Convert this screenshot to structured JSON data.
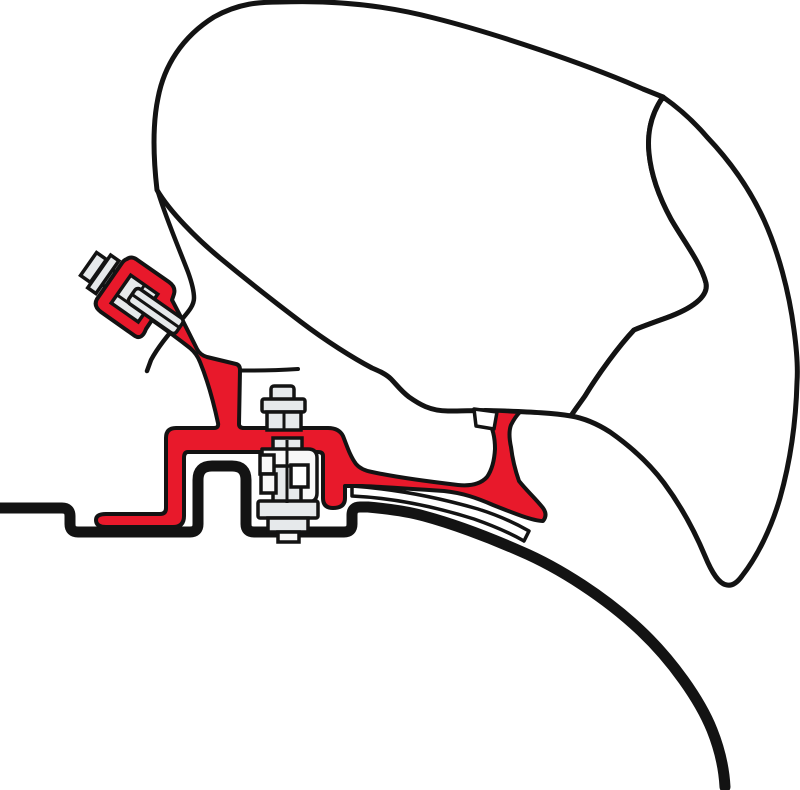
{
  "image": {
    "width": 800,
    "height": 790,
    "background": "#ffffff"
  },
  "diagram": {
    "kind": "technical-illustration",
    "subject": "awning-to-roof adapter bracket, side cross-section",
    "text_content": "none",
    "colors": {
      "outline": "#131313",
      "bracket_red": "#e8192b",
      "roof_cyan": "#2adde8",
      "metal_gray": "#e6e9eb",
      "metal_light": "#f8f8f8",
      "white": "#ffffff"
    },
    "parts": [
      {
        "name": "awning-case",
        "description": "large rounded awning cassette body, white with black outline"
      },
      {
        "name": "awning-front-panel",
        "description": "curved crescent front cover hanging down on the right"
      },
      {
        "name": "adapter-bracket",
        "description": "red mounting bracket: clamp ring, diagonal arm, post, horizontal rail, left foot, hanging finger, right strut with curved foot"
      },
      {
        "name": "clamp-bolt",
        "description": "tilted gray bolt with head, washer, shaft and clamped block at upper left"
      },
      {
        "name": "rail-bolt",
        "description": "vertical gray bolt through rail with C-clamp bracket and nut stack"
      },
      {
        "name": "mounting-shim",
        "description": "thin white curved spacer strip under red foot"
      },
      {
        "name": "support-pad",
        "description": "small white pad at top of right strut"
      },
      {
        "name": "roof-profile",
        "description": "cyan vehicle roof contour with raised rib and curved descent to lower right"
      }
    ]
  },
  "paths": {
    "case_body": "M157,190 C153,155 153,122 158,98 C164,66 182,37 214,17 C239,3 260,2 280,2 C332,0 384,5 434,18 C494,33 586,64 643,89 L663,97 C651,114 647,133 649,153 C651,174 659,197 671,219 C683,240 701,263 706,283 C709,297 691,309 666,318 C652,323 641,327 634,330 C619,346 599,373 585,396 C578,406 574,411 571,416 C553,413 531,412 505,411 C482,410 461,411 448,411 C430,411 419,404 409,397 C401,391 396,384 391,379 C386,374 379,371 372,368 C353,358 326,341 301,322 C272,300 243,277 220,258 C197,239 170,212 157,190 Z",
    "front_panel": "M663,97 C673,104 690,117 707,137 C727,158 748,185 764,220 C778,251 789,291 794,330 C797,352 798,368 797,382 C796,420 791,459 780,498 C771,529 757,557 742,576 C737,583 732,586 727,585 C719,584 712,573 705,556 C695,532 681,506 664,483 C649,463 630,446 610,432 C596,423 583,418 571,416 C574,411 578,406 585,396 C599,373 619,346 634,330 C641,327 652,323 666,318 C691,309 709,297 706,283 C701,263 683,240 671,219 C659,197 651,174 649,153 C647,133 651,114 663,97 Z",
    "case_edge_line": "M158,192 C166,218 178,246 188,272 C192,283 194,291 194,298 C194,305 189,311 183,318 C172,330 159,345 151,360 L147,371",
    "case_bottom_line": "M210,369 C237,371 268,371 298,369",
    "roof_line": "M0,508 L62,508 Q70,508 70,516 L70,524 Q70,532 78,532 L190,532 Q198,532 198,524 L198,480 Q198,466 212,466 L232,466 Q246,466 246,480 L246,524 Q246,532 254,532 L344,532 Q352,532 352,524 L352,515 Q352,507 360,507 L368,507 C390,509 410,512 424,516 C450,523 486,536 520,551 C560,568 606,598 640,630 C672,660 700,700 712,730 C720,750 724,768 725,787",
    "shim": "M352,486 C395,489 440,498 478,509 C497,515 515,523 529,531 L524,541 C510,533 494,526 474,519 C436,507 393,498 352,496 Z",
    "bracket_red": "M127,259 Q131,256 136,259 L169,282 Q176,287 174,294 L172,300 C180,315 190,335 197,349 Q200,355 207,357 L236,364 Q240,365 240,370 L239,424 Q239,428 244,428 L328,428 Q339,428 343,436 C347,446 350,456 356,464 Q361,470 372,472 C395,477 424,481 458,485 Q478,487 487,477 Q494,467 495,449 Q495,431 488,421 Q484,415 480,413 L485,410 L520,412 Q515,417 511,425 Q508,433 511,447 Q513,464 519,481 C526,490 536,499 543,508 Q548,515 543,521 C533,521 513,513 493,505 C477,498 463,493 444,491 C415,489 385,487 362,486 L345,486 L345,498 Q345,508 333,508 Q323,508 323,498 L323,456 Q323,452 318,452 L188,452 Q184,452 184,458 L184,516 Q184,527 173,527 L106,527 Q96,527 96,520 Q96,514 106,514 L160,514 Q166,514 166,508 L166,438 Q166,428 176,428 L214,428 Q219,428 218,423 C215,409 209,384 200,362 Q197,354 190,348 C176,337 162,327 152,320 L146,329 Q142,340 135,336 L101,312 Q93,306 97,299 L122,263 Q124,260 127,259 Z",
    "clamp_pad": "M474,409 L497,412 L494,429 L476,426 Z",
    "rail_clamp": "M262,449 L308,449 Q317,449 317,458 L317,493 Q317,502 308,502 L301,502 L301,466 L262,466 Z",
    "block_facets": "M127,281 L160,281 M144,257 L144,281",
    "shaft_b_line": "M139,272 L197,272",
    "rail_bolt_lines": "M287,440 L287,503 M284,412 L284,430"
  }
}
